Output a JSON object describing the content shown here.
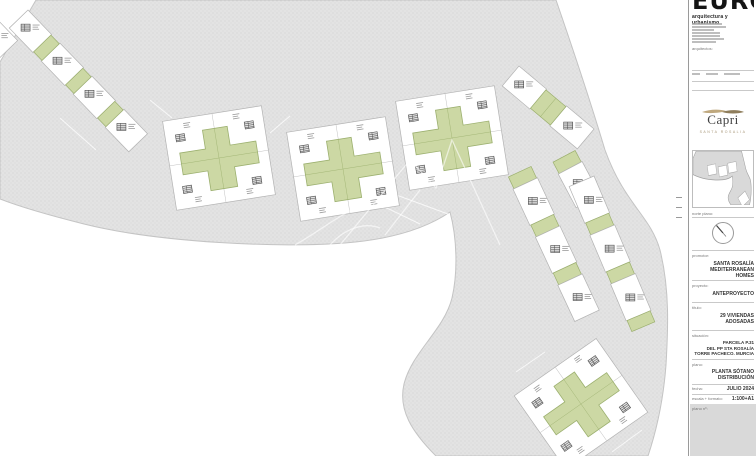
{
  "architect_block": {
    "logo_text": "EURO",
    "tagline": "arquitectura y urbanismo",
    "architects_label": "arquitectos:"
  },
  "brand": {
    "name": "Capri",
    "subtitle": "SANTA ROSALIA"
  },
  "map_section": {
    "north_label": "norte plano:"
  },
  "fields": {
    "promotor_label": "promotor:",
    "promotor_line1": "SANTA ROSALÍA",
    "promotor_line2": "MEDITERRANEAN HOMES",
    "proyecto_label": "proyecto:",
    "proyecto_value": "ANTEPROYECTO",
    "titulo_label": "título:",
    "titulo_line1": "29 VIVIENDAS",
    "titulo_line2": "ADOSADAS",
    "situacion_label": "situación:",
    "situacion_line1": "PARCELA P.31",
    "situacion_line2": "DEL PP STA ROSALÍA",
    "situacion_line3": "TORRE PACHECO. MURCIA",
    "plano_label": "plano:",
    "plano_line1": "PLANTA SÓTANO",
    "plano_line2": "DISTRIBUCIÓN",
    "fecha_label": "fecha:",
    "fecha_value": "JULIO 2024",
    "escala_label": "escala + formato:",
    "escala_value": "1:100+A1",
    "plano_num_label": "plano nº:"
  },
  "colors": {
    "road_fill": "#e3e3e3",
    "road_dot": "#cccccc",
    "parcel_stroke": "#b3b3b3",
    "garden_green": "#ccd8a4",
    "garden_stroke": "#9cb06f",
    "brand_gold": "#bfa87e"
  }
}
